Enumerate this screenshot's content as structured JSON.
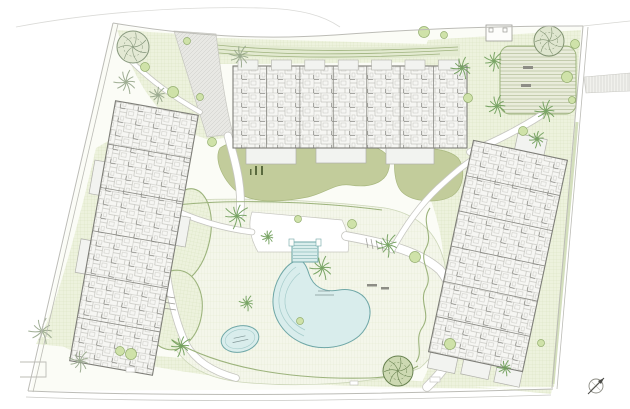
{
  "plan": {
    "colors": {
      "site": "#fbfcf6",
      "poolFill": "#d9edec",
      "poolEdge": "#6fa7a7",
      "poolInner": "#a5cccb",
      "hedge": "#9cb37c",
      "deepLawn": "#c2cc9b",
      "deepLawnEdge": "#a9b87f",
      "deckEdge": "#ccd6b8",
      "pathCasing": "#c6c6c0",
      "pathFill": "#ffffff",
      "buildingEdge": "#7e7e78",
      "divider": "#8c8c86",
      "terrFill": "#f2f3f0",
      "terrEdge": "#b1b1ab",
      "boundary": "#bcbcb6",
      "palmGreen": "#6f9e5a",
      "palmGray": "#97a78b",
      "bushFill": "#cfe2a9",
      "bushEdge": "#93ae6e",
      "hedgeBandFill": "#e3ead1",
      "hedgeBandLine": "#9fb37e",
      "benchDark": "#8d8d85",
      "stickGreen": "#5a6a3e",
      "greenStrip": "#cfdbb6",
      "labelInk": "#7f9494",
      "structureEdge": "#9a9a94",
      "stairInk": "#9a9a94",
      "compassInk": "#4a4a46"
    },
    "site": "M113,24 C180,36 250,40 330,35 C430,29 505,27 583,27 L553,388 L30,391 Z",
    "lawns": [
      "M117,30 C140,95 166,128 210,140 L231,137 L214,36 Z",
      "M214,38 L463,45 L464,62 L218,64 Z",
      "M96,148 C78,226 58,300 42,334 C72,354 106,366 142,371 L152,371 L110,140 Z",
      "M428,40 L581,30 L554,387 L420,386 C444,342 452,272 436,216 C429,191 416,166 401,149 C406,112 416,72 428,40 Z",
      "M40,336 C120,366 230,382 330,385 C410,388 480,389 552,389 L551,394 L36,344 Z"
    ],
    "hedge_band": {
      "fill": "M205,40 C280,49 360,49 460,44 L460,56 C360,60 280,60 206,54 Z",
      "lines": [
        "M207,44 C280,52 360,52 458,47",
        "M207,48 C280,56 360,55 458,50",
        "M208,52 C280,59 360,58 440,54"
      ]
    },
    "deck": "M162,202 C230,196 320,200 385,208 C420,214 440,235 446,270 C452,310 444,348 420,368 C380,384 300,388 240,382 C205,378 180,364 170,338 C158,305 154,245 162,202 Z",
    "ovals": [
      {
        "x": 184,
        "y": 236,
        "rx": 26,
        "ry": 48,
        "r": 12
      },
      {
        "x": 174,
        "y": 310,
        "rx": 28,
        "ry": 40,
        "r": 8
      }
    ],
    "deep_lawns": [
      "M220,148 C235,138 268,136 290,141 C315,147 338,139 358,143 C380,147 392,153 389,168 C386,184 368,188 350,185 C335,183 326,193 308,197 C288,201 262,204 244,196 C228,189 212,162 220,148 Z",
      "M398,150 C420,146 448,148 458,158 C466,168 464,188 452,196 C438,204 412,202 402,192 C394,184 392,160 398,150 Z"
    ],
    "lawn_sticks": [
      [
        255,
        166,
        2,
        9
      ],
      [
        261,
        166,
        2,
        9
      ],
      [
        250,
        169,
        1.5,
        6
      ]
    ],
    "plaza": {
      "x": 500,
      "y": 46,
      "w": 76,
      "h": 68,
      "rx": 10
    },
    "plaza_benches": [
      [
        523,
        66,
        10,
        3
      ],
      [
        521,
        84,
        10,
        3
      ]
    ],
    "structure": {
      "x": 486,
      "y": 25,
      "w": 26,
      "h": 16,
      "posts": [
        [
          489,
          28,
          4,
          4
        ],
        [
          503,
          28,
          4,
          4
        ]
      ]
    },
    "parking": "M584,77 L630,73 L630,91 L586,93 Z",
    "driveway": "M174,31 L216,34 C221,75 226,108 233,134 L207,137 C196,102 184,64 174,31 Z",
    "crossing": "M252,212 L342,220 C348,232 350,242 348,252 L258,252 C250,238 248,224 252,212 Z",
    "paths": [
      {
        "d": "M228,136 C238,170 242,190 240,214",
        "w": 7
      },
      {
        "d": "M160,200 C163,260 170,310 186,344 C196,362 214,372 236,378",
        "w": 6
      },
      {
        "d": "M346,236 C390,244 420,252 440,270 C458,292 462,330 450,358 C444,370 436,378 427,387",
        "w": 8
      },
      {
        "d": "M392,250 C404,228 420,205 438,188 C450,177 460,168 472,160",
        "w": 5
      },
      {
        "d": "M540,116 C518,130 494,142 470,152",
        "w": 6
      },
      {
        "d": "M128,58 C152,82 172,96 200,112",
        "w": 4
      },
      {
        "d": "M252,232 C220,228 190,218 166,206",
        "w": 5
      }
    ],
    "stairs": [
      [
        [
          366,
          238,
          368,
          248
        ],
        [
          371,
          239,
          373,
          249
        ],
        [
          376,
          240,
          378,
          250
        ],
        [
          381,
          241,
          383,
          251
        ]
      ],
      [
        [
          163,
          296,
          175,
          298
        ],
        [
          163,
          302,
          175,
          304
        ],
        [
          163,
          308,
          176,
          310
        ]
      ]
    ],
    "hedges": [
      "M430,208 C420,222 434,234 426,248 C418,262 434,274 426,288 C418,302 432,314 422,328 C414,340 424,352 416,362",
      "M172,340 C220,368 290,380 370,378 C392,377 408,372 418,366",
      "M168,206 C230,198 320,202 382,210"
    ],
    "green_strip": {
      "d": "M577,122 L553,384",
      "w": 3
    },
    "pool": {
      "outer": "M295,261 C284,266 274,282 273,299 C272,318 284,335 302,343 C322,352 346,347 359,336 C370,326 373,311 367,301 C362,292 350,288 339,290 C323,293 313,286 309,274 C306,264 302,258 295,261 Z",
      "inner": [
        "M296,267 C288,272 280,284 279,298 C278,314 288,329 304,336",
        "M300,273 C293,278 286,288 285,299 C284,312 292,324 305,330"
      ],
      "steps": {
        "x": 292,
        "y": 242,
        "w": 26,
        "h": 20,
        "rungs": 5
      },
      "step_posts": [
        [
          289,
          239,
          5,
          7
        ],
        [
          316,
          239,
          5,
          7
        ]
      ],
      "label_dashes": [
        [
          318,
          291,
          330,
          291
        ],
        [
          315,
          295,
          334,
          295
        ]
      ]
    },
    "kids_pool": {
      "x": 240,
      "y": 339,
      "rx": 19,
      "ry": 13,
      "rot": -12,
      "label_dashes": [
        [
          -6,
          -2,
          6,
          -2
        ],
        [
          -8,
          2,
          8,
          2
        ]
      ]
    },
    "buildings": [
      {
        "x": 350,
        "y": 107,
        "r": 0,
        "w": 234,
        "h": 82,
        "div": 7,
        "axis": "v",
        "balc": true,
        "terr": [
          [
            -104,
            41,
            50,
            16
          ],
          [
            -34,
            41,
            50,
            15
          ],
          [
            36,
            41,
            48,
            16
          ]
        ]
      },
      {
        "x": 134,
        "y": 238,
        "r": 10,
        "w": 84,
        "h": 264,
        "div": 6,
        "axis": "h",
        "balc": false,
        "terr": [
          [
            -52,
            -70,
            10,
            34
          ],
          [
            -52,
            10,
            10,
            34
          ],
          [
            42,
            -30,
            10,
            30
          ]
        ]
      },
      {
        "x": 498,
        "y": 256,
        "r": 12,
        "w": 96,
        "h": 216,
        "div": 6,
        "axis": "h",
        "balc": false,
        "terr": [
          [
            -46,
            108,
            28,
            16
          ],
          [
            -12,
            108,
            28,
            15
          ],
          [
            22,
            108,
            26,
            16
          ],
          [
            -6,
            -124,
            30,
            16
          ]
        ]
      }
    ],
    "round_trees": [
      {
        "x": 133,
        "y": 47,
        "r": 16,
        "f": "#e3e9d4",
        "s": "#85967b"
      },
      {
        "x": 549,
        "y": 41,
        "r": 15,
        "f": "#dfe6cf",
        "s": "#7f9170"
      },
      {
        "x": 398,
        "y": 371,
        "r": 15,
        "f": "#cdd9b2",
        "s": "#66804e"
      }
    ],
    "palms": [
      [
        240,
        56,
        11,
        "k"
      ],
      [
        126,
        82,
        12,
        "k"
      ],
      [
        158,
        95,
        9,
        "k"
      ],
      [
        42,
        331,
        13,
        "k"
      ],
      [
        80,
        361,
        11,
        "k"
      ],
      [
        237,
        216,
        13,
        "g"
      ],
      [
        322,
        268,
        12,
        "g"
      ],
      [
        388,
        245,
        12,
        "g"
      ],
      [
        181,
        346,
        11,
        "g"
      ],
      [
        247,
        303,
        8,
        "g"
      ],
      [
        268,
        237,
        7,
        "g"
      ],
      [
        462,
        68,
        11,
        "g"
      ],
      [
        494,
        61,
        10,
        "g"
      ],
      [
        497,
        106,
        11,
        "g"
      ],
      [
        546,
        111,
        11,
        "g"
      ],
      [
        537,
        139,
        9,
        "g"
      ],
      [
        505,
        368,
        8,
        "g"
      ]
    ],
    "bushes": [
      [
        187,
        41
      ],
      [
        145,
        67
      ],
      [
        173,
        92
      ],
      [
        200,
        97
      ],
      [
        212,
        142
      ],
      [
        424,
        32
      ],
      [
        444,
        35
      ],
      [
        575,
        44
      ],
      [
        567,
        77
      ],
      [
        572,
        100
      ],
      [
        523,
        131
      ],
      [
        450,
        344
      ],
      [
        541,
        343
      ],
      [
        120,
        351
      ],
      [
        131,
        354
      ],
      [
        298,
        219
      ],
      [
        352,
        224
      ],
      [
        415,
        257
      ],
      [
        300,
        321
      ],
      [
        468,
        98
      ]
    ],
    "benches": [
      [
        367,
        284,
        10,
        2.5
      ],
      [
        381,
        287,
        8,
        2.5
      ]
    ],
    "utility_boxes": [
      [
        126,
        367,
        9,
        5
      ],
      [
        430,
        377,
        10,
        5
      ],
      [
        350,
        381,
        8,
        4
      ]
    ],
    "boundaries": [
      {
        "d": "M113,23 C190,36 260,40 335,35 C430,28 505,26 583,26",
        "w": 1,
        "o": 1
      },
      {
        "d": "M16,27 C95,12 185,6 262,8 C302,9 324,16 340,27",
        "w": 0.8,
        "o": 0.55
      },
      {
        "d": "M583,26 L630,21",
        "w": 0.8,
        "o": 0.6
      },
      {
        "d": "M113,23 L28,391",
        "w": 1,
        "o": 1
      },
      {
        "d": "M118,24 L33,392",
        "w": 0.8,
        "o": 1
      },
      {
        "d": "M28,391 C160,396 320,396 553,389",
        "w": 1,
        "o": 1
      },
      {
        "d": "M26,397 C160,402 320,402 551,395",
        "w": 0.8,
        "o": 0.8
      },
      {
        "d": "M583,26 L552,388",
        "w": 1,
        "o": 1
      },
      {
        "d": "M588,27 L557,389",
        "w": 0.8,
        "o": 1
      },
      {
        "d": "M20,362 L46,362 L46,377 L20,377",
        "w": 0.9,
        "o": 1
      }
    ],
    "compass": {
      "x": 596,
      "y": 386,
      "r": 7
    }
  }
}
